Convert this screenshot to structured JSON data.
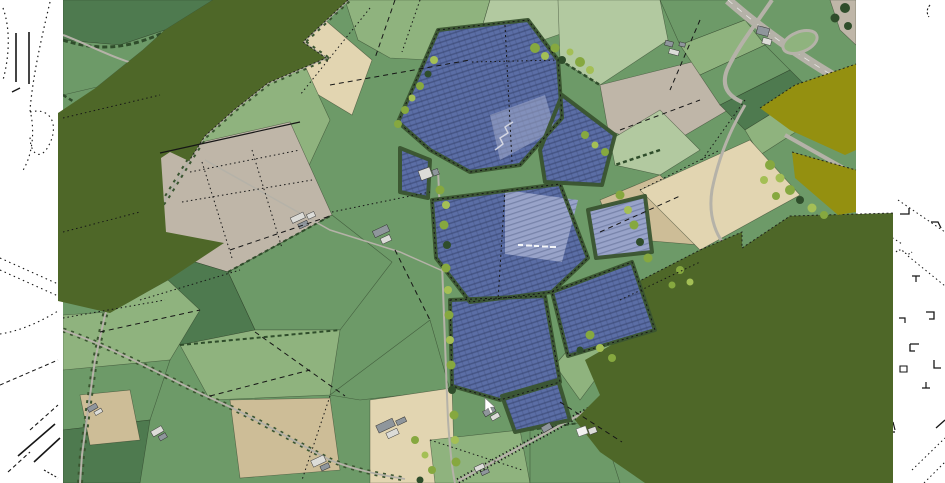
{
  "map": {
    "viewport": {
      "width_px": 945,
      "height_px": 483
    },
    "cursor": {
      "visible": true,
      "x": 487,
      "y": 402,
      "shape": "white-arrow"
    },
    "layers": [
      {
        "name": "white-map-margin"
      },
      {
        "name": "cadastral-line-work"
      },
      {
        "name": "aerial-imagery-fields"
      },
      {
        "name": "roads-and-tree-lanes"
      },
      {
        "name": "olive-plan-overlay"
      },
      {
        "name": "mustard-plan-overlay"
      },
      {
        "name": "solar-panel-blocks"
      },
      {
        "name": "farm-buildings"
      },
      {
        "name": "mouse-cursor"
      }
    ],
    "features": {
      "solar_panel_blocks": 10,
      "olive_overlay_polygons": 2,
      "mustard_overlay_polygons": 2,
      "farm_building_clusters": 12,
      "tiny_annotation_legible": false
    },
    "palette": {
      "background_white": "#ffffff",
      "cadastral_line": "#161616",
      "overlay_olive": "#4e6728",
      "overlay_mustard": "#949010",
      "panel_blue": "#5b6ea6",
      "panel_blue_light": "#98a3c9",
      "panel_dot": "#2f3c63",
      "field_green": "#6d9a68",
      "field_green_dark": "#4e7a4f",
      "field_green_light": "#8fb37e",
      "field_green_pale": "#b2c9a0",
      "field_beige": "#e2d5b1",
      "field_tan": "#cdbd97",
      "field_grey": "#bfb6a8",
      "tree_dark": "#2f4d2b",
      "tree_belt": "#3a5530",
      "canopy": "#86a83f",
      "canopy_light": "#a4bf55",
      "road_grey": "#b5b2a8",
      "roof_light": "#dcdcd8",
      "roof_dark": "#8f969c",
      "cursor_white": "#ffffff"
    }
  }
}
